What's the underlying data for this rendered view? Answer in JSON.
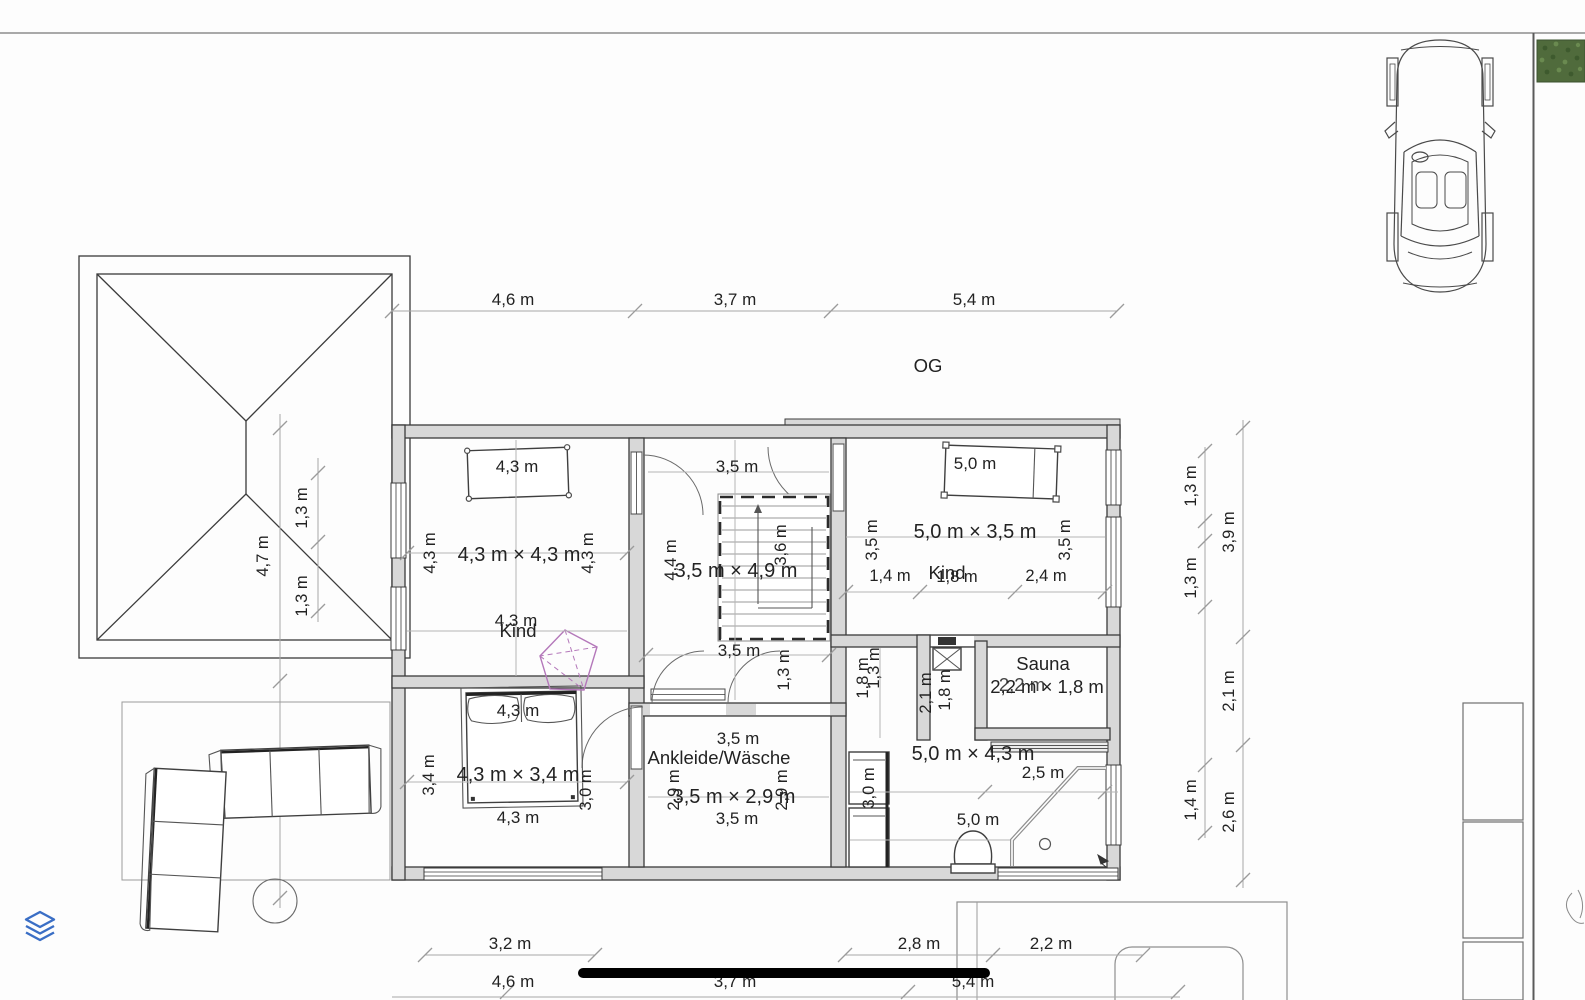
{
  "colors": {
    "accent_blue": "#3a6ec5",
    "lamp_purple": "#b478ba",
    "hedge_green": "#506b3c",
    "wall_gray": "#d8d8d8"
  },
  "floor_label": "OG",
  "top_dims": [
    "4,6 m",
    "3,7 m",
    "5,4 m"
  ],
  "bottom_dims_row1": [
    "3,2 m",
    "2,8 m",
    "2,2 m"
  ],
  "bottom_dims_row2": [
    "4,6 m",
    "3,7 m",
    "5,4 m"
  ],
  "left_dims": {
    "seg1": "4,7 m",
    "seg2": "3,8 m",
    "sub1": "1,3 m",
    "sub2": "1,3 m"
  },
  "right_dims": {
    "inner": [
      "1,3 m",
      "1,3 m",
      "1,4 m"
    ],
    "outer": [
      "3,9 m",
      "2,1 m",
      "2,6 m"
    ]
  },
  "rooms": {
    "kind_nw": {
      "name": "Kind",
      "size": "4,3 m × 4,3 m",
      "bed": "4,3 m",
      "left": "4,3 m",
      "right": "4,3 m",
      "bottom": "4,3 m"
    },
    "hall": {
      "size": "3,5 m × 4,9 m",
      "top": "3,5 m",
      "left": "4,4 m",
      "stair": "3,6 m",
      "bottom": "3,5 m",
      "corner": "1,3 m"
    },
    "kind_ne": {
      "name": "Kind",
      "size": "5,0 m × 3,5 m",
      "bed": "5,0 m",
      "left": "3,5 m",
      "right": "3,5 m",
      "d1": "1,4 m",
      "d2": "1,8 m",
      "d3": "2,4 m"
    },
    "bedroom": {
      "size": "4,3 m × 3,4 m",
      "bed": "4,3 m",
      "left": "3,4 m",
      "right": "3,0 m",
      "bottom": "4,3 m"
    },
    "ankleide": {
      "name": "Ankleide/Wäsche",
      "size": "3,5 m × 2,9 m",
      "top": "3,5 m",
      "left": "2,9 m",
      "right": "2,9 m",
      "bottom": "3,5 m"
    },
    "bath": {
      "size": "5,0 m × 4,3 m",
      "shower": "2,5 m",
      "bottom": "5,0 m",
      "v1": "1,8 m",
      "v2": "1,3 m",
      "v3": "2,1 m",
      "v4": "1,8 m",
      "cab": "3,0 m"
    },
    "sauna": {
      "name": "Sauna",
      "size": "2,2 m × 1,8 m",
      "overlay": "2,2 m"
    }
  }
}
